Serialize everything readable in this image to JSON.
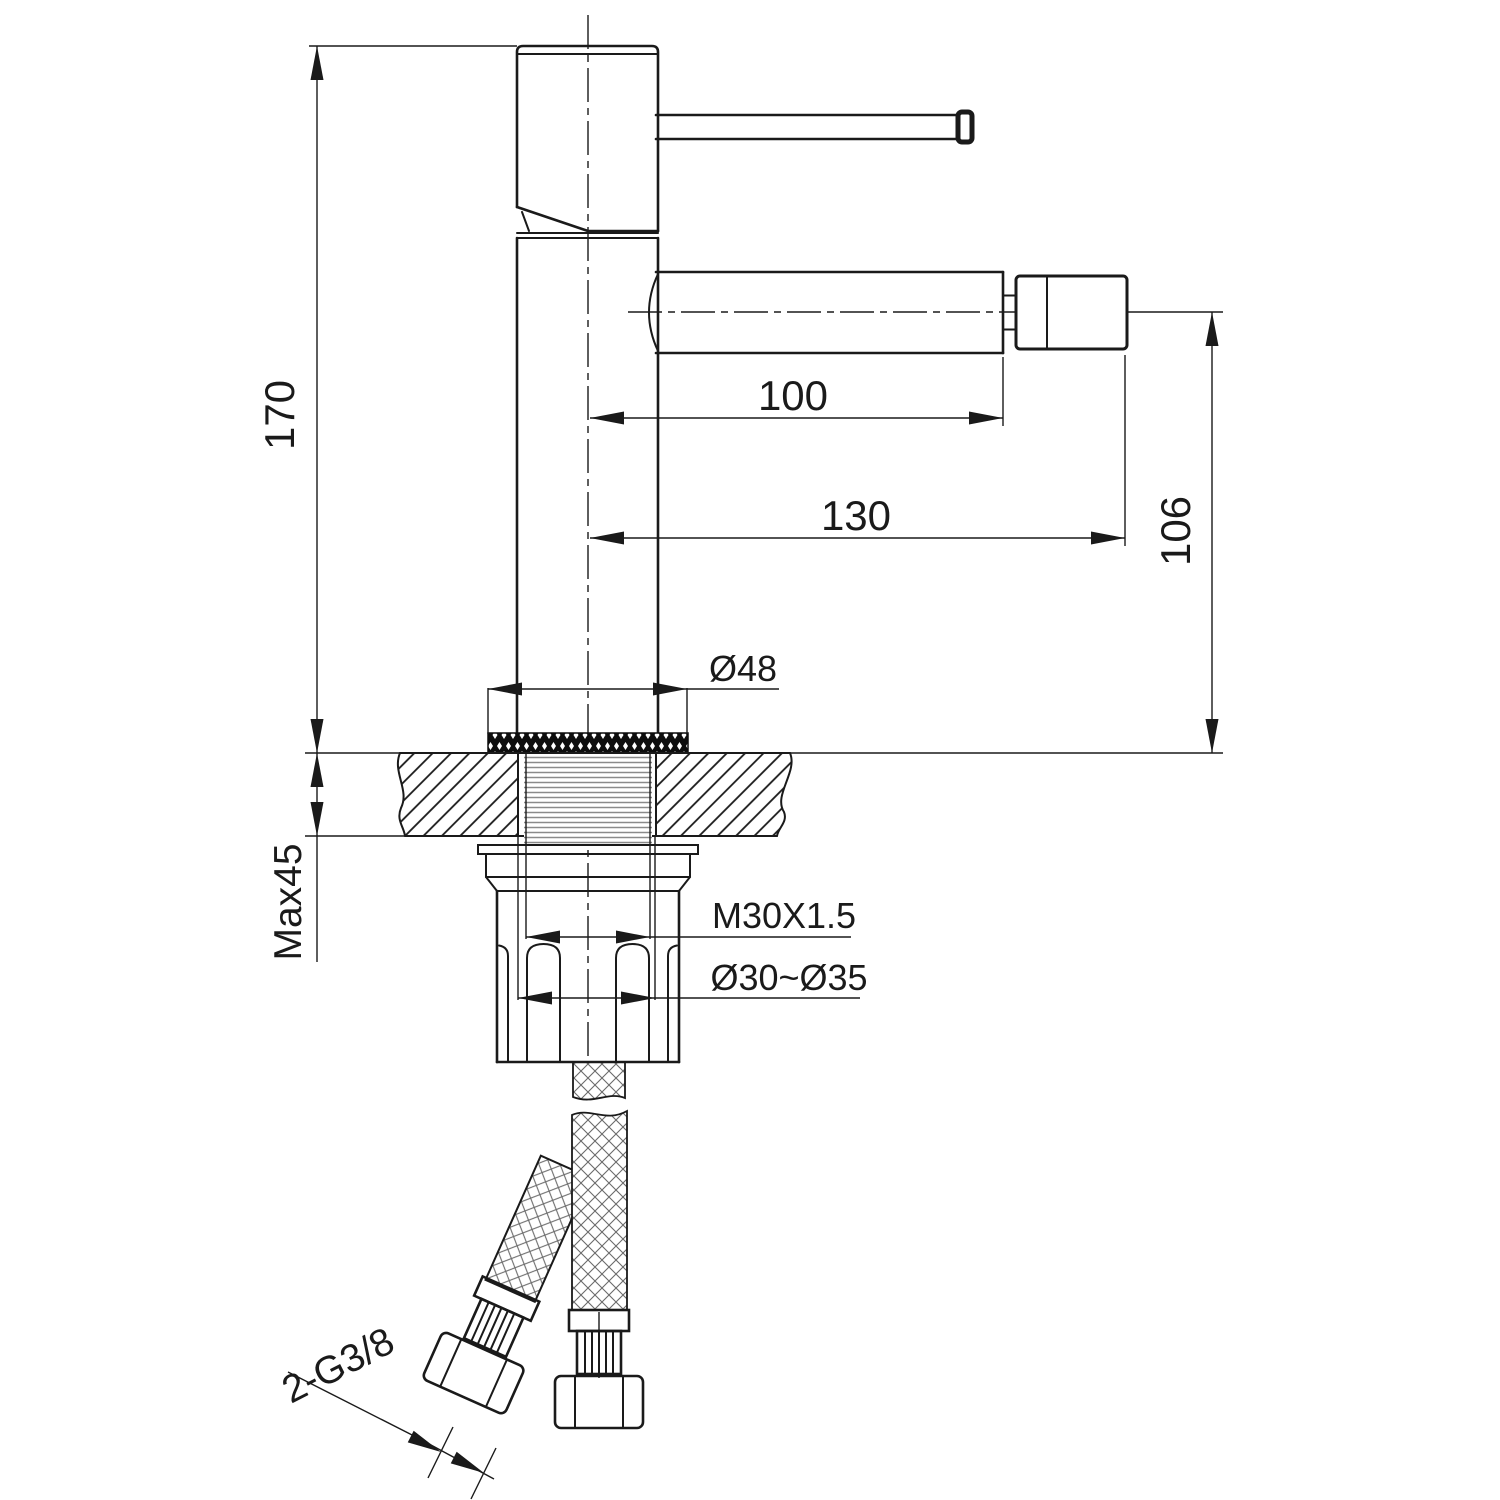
{
  "drawing": {
    "subject": "single-lever bidet faucet installation dimension drawing",
    "units": "mm",
    "colors": {
      "ink": "#1a1a1a",
      "thread_gray": "#8a8a8a"
    },
    "labels": {
      "height_overall": "170",
      "spout_reach": "100",
      "reach_overall": "130",
      "spout_height": "106",
      "base_diameter": "Ø48",
      "max_deck_thickness": "Max45",
      "shank_thread": "M30X1.5",
      "hole_diameter_range": "Ø30~Ø35",
      "supply_hose_thread": "2-G3/8"
    }
  }
}
